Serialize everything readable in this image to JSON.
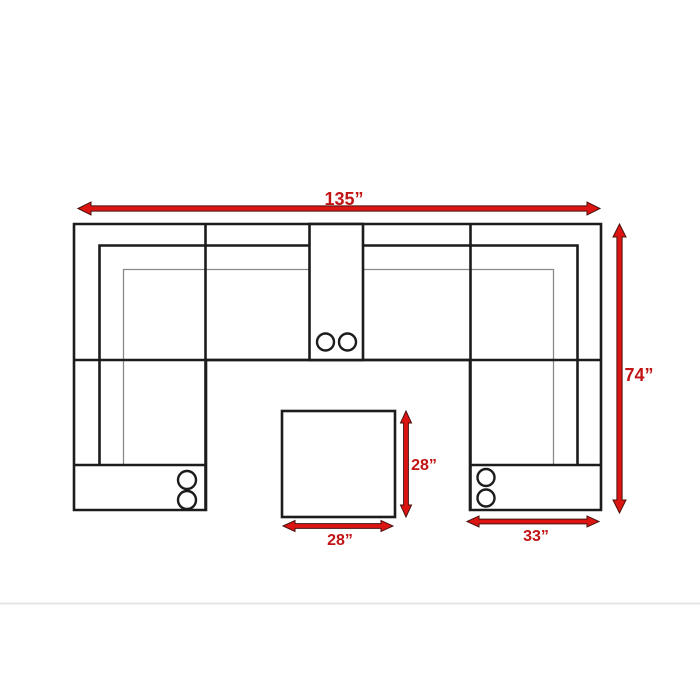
{
  "diagram": {
    "kind": "sectional-sofa-floor-plan",
    "colors": {
      "accent_red": "#DD1512",
      "label_red": "#C11414",
      "outline_black": "#1C1C1C",
      "inner_gray": "#8A8A8A",
      "ottoman_green": "#DFEED8",
      "page_divider_gray": "#E4E4E4",
      "background": "#FFFFFF"
    },
    "dimensions": {
      "overall_width": "135”",
      "overall_depth": "74”",
      "ottoman_depth": "28”",
      "ottoman_width": "28”",
      "chaise_width": "33”"
    },
    "cupholders": {
      "center_console": 2,
      "left_chaise_console": 2,
      "right_chaise_console": 2
    }
  }
}
